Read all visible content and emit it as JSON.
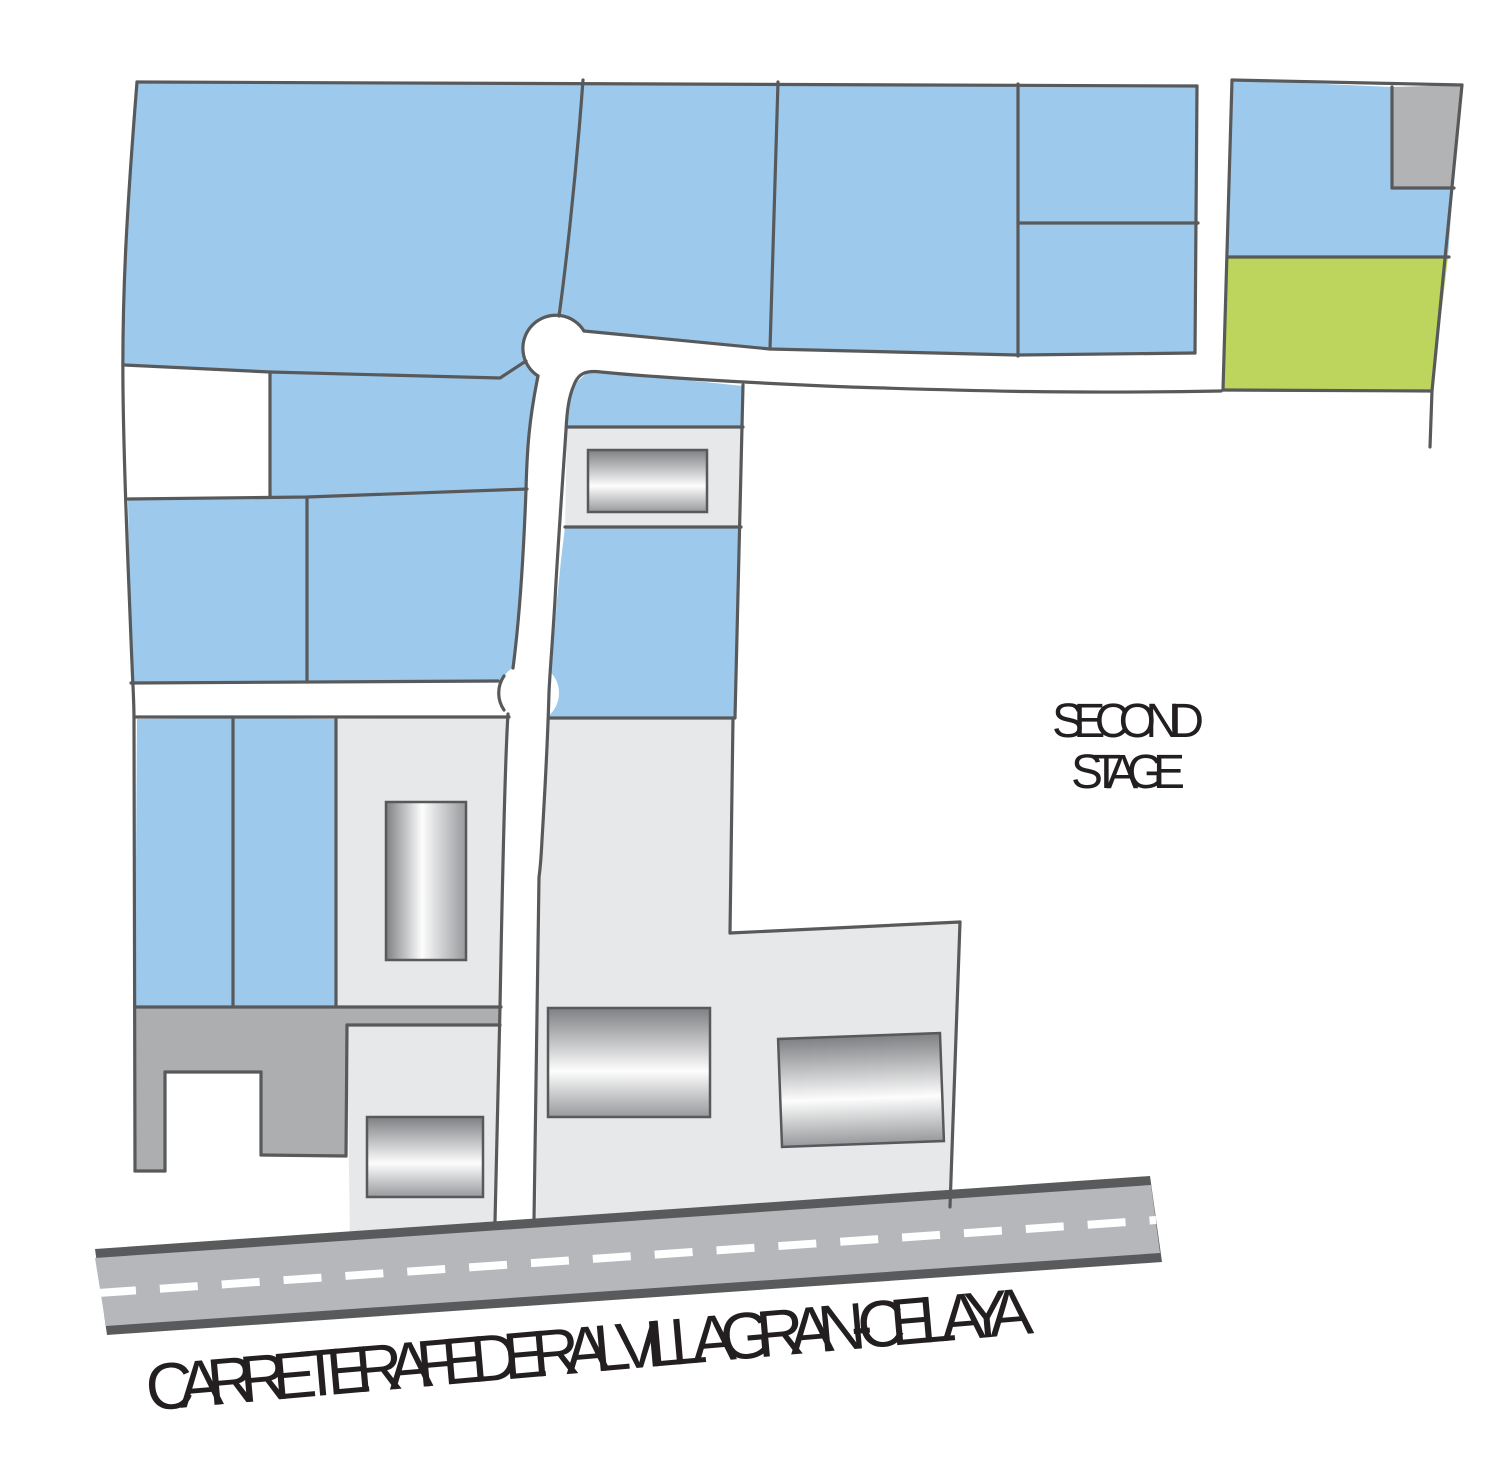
{
  "labels": {
    "second_stage_line1": "SECOND",
    "second_stage_line2": "STAGE",
    "highway_name": "CARRETERA FEDERAL VILLAGRAN-CELAYA"
  },
  "palette": {
    "lot_blue": "#9DCAEC",
    "lot_green": "#BDD55C",
    "lot_gray": "#B2B3B5",
    "lot_gray_dark": "#ACAEB0",
    "building_pad_gray": "#E7E8E9",
    "outline_gray": "#58595B",
    "road_white": "#FFFFFF",
    "highway_surface": "#B5B7BA",
    "highway_border": "#595A5C",
    "highway_dash": "#FFFFFF",
    "label_color": "#231F20"
  },
  "inventory": {
    "blue_lots": 13,
    "green_lots": 1,
    "gray_lots": 2,
    "building_pads": 4,
    "buildings": 5,
    "roundabouts": 2
  }
}
